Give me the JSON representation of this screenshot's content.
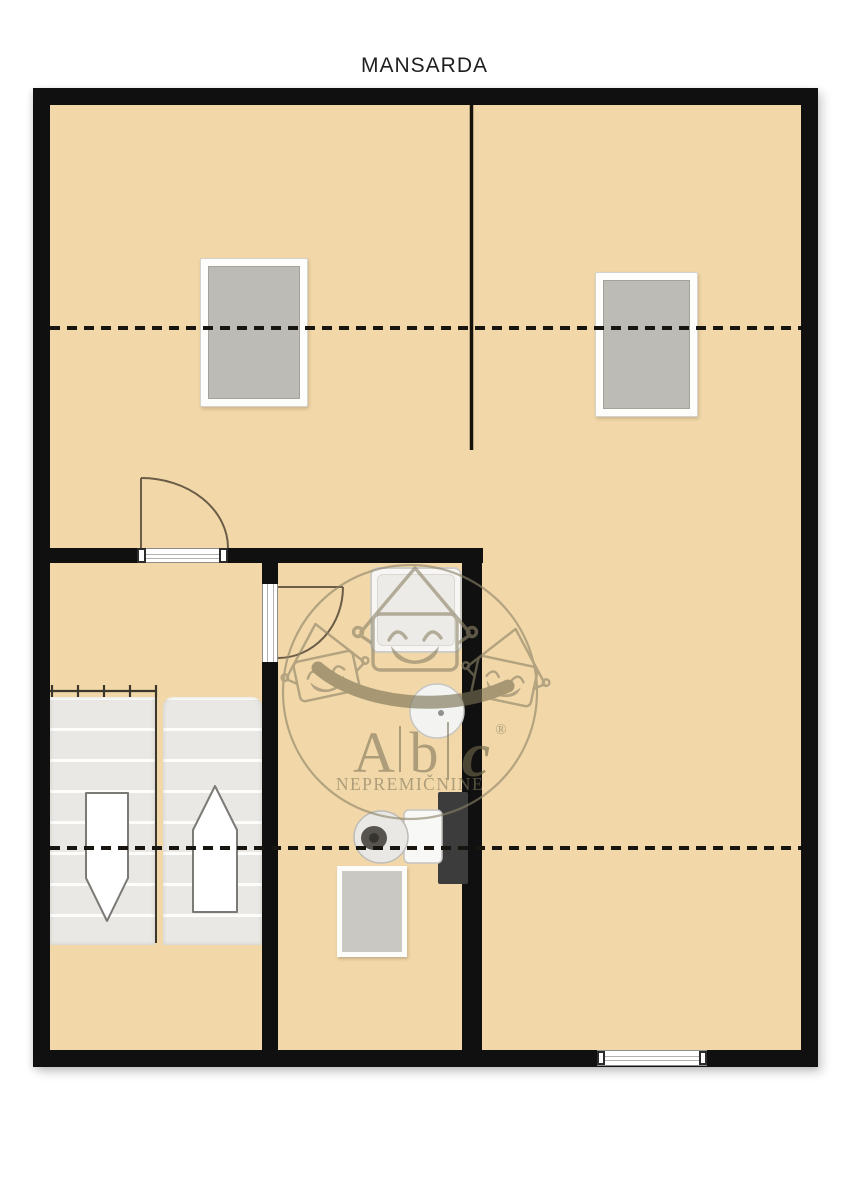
{
  "page": {
    "title": "MANSARDA",
    "background_color": "#ffffff"
  },
  "plan": {
    "floor_color": "#f2d8a8",
    "wall_color": "#101010",
    "dash_line_color": "#181410",
    "skylight_glass_color": "#bdbbb5",
    "stair_step_color": "#e9e8e4",
    "door_arc_color": "#6b5d47",
    "fixture_white": "#f7f6f4",
    "toilet_dark_shelf_color": "#3c3c3c"
  },
  "watermark": {
    "letters": [
      "A",
      "b",
      "c"
    ],
    "registered": "®",
    "subtitle": "NEPREMIČNINE",
    "brand_color": "#8d8468"
  }
}
